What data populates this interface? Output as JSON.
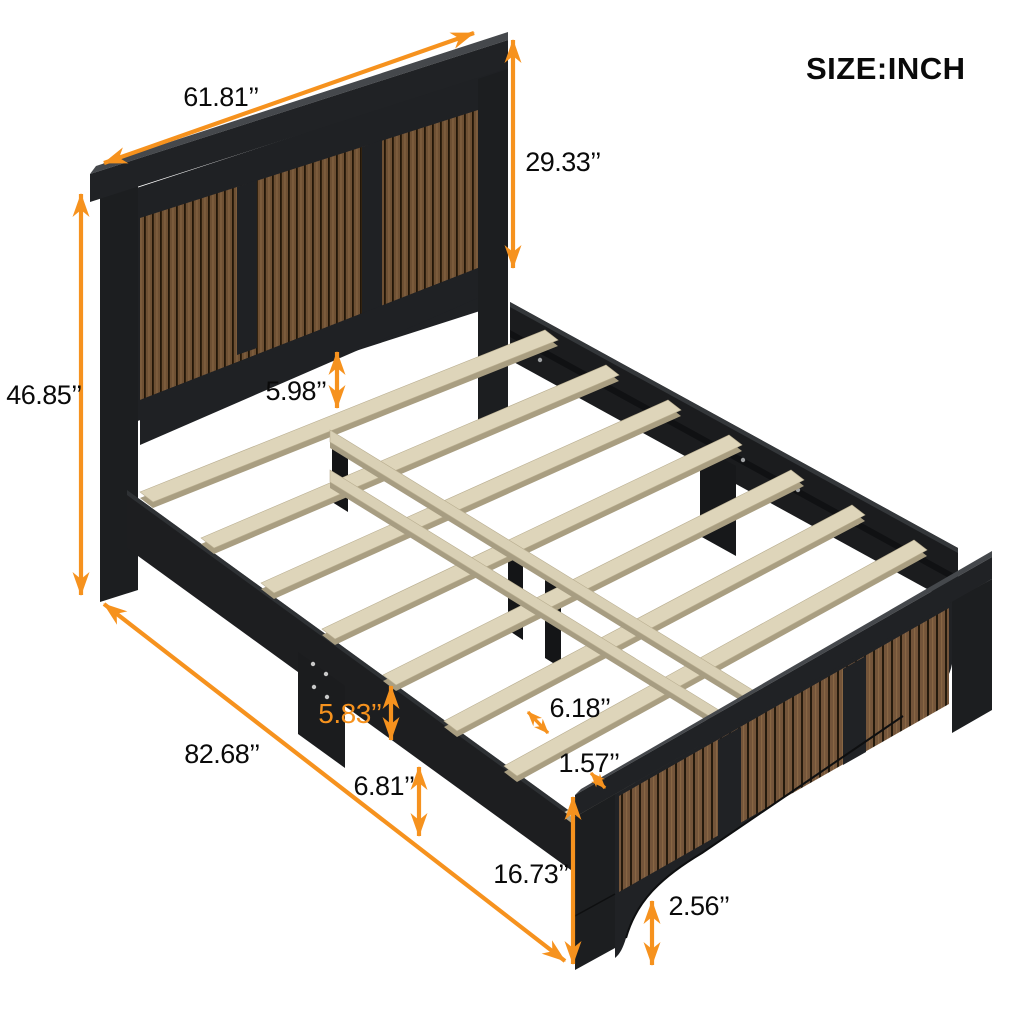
{
  "title": "SIZE:INCH",
  "colors": {
    "accent": "#F6921E",
    "frame_black": "#1F2124",
    "frame_top_face": "#45484C",
    "wood_panel": "#6E5033",
    "wood_groove": "#221608",
    "slat_wood": "#DED5BA",
    "slat_edge": "#A99E81",
    "background": "#FFFFFF",
    "label_text": "#0A0A0A"
  },
  "dimensions": {
    "headboard_width": "61.81’’",
    "headboard_height": "29.33’’",
    "headboard_to_slat_gap": "5.98’’",
    "overall_height": "46.85’’",
    "overall_length": "82.68’’",
    "side_rail_height": "5.83’’",
    "under_bed_clearance": "6.81’’",
    "slat_spacing": "6.18’’",
    "slat_thickness": "1.57’’",
    "footboard_height": "16.73’’",
    "foot_clearance": "2.56’’"
  }
}
